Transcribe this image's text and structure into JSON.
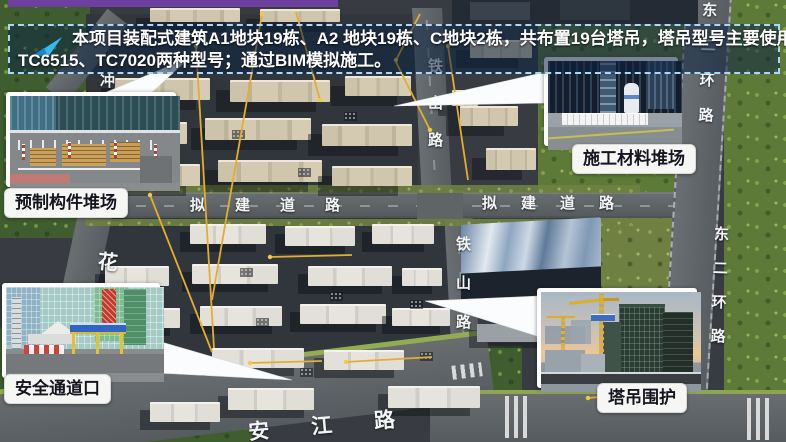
{
  "banner": {
    "icon": "paper-plane",
    "line1": "本项目装配式建筑A1地块19栋、A2 地块19栋、C地块2栋，共布置19台塔吊，塔吊型号主要使用",
    "line2": "TC6515、TC7020两种型号；通过BIM模拟施工。"
  },
  "callouts": {
    "prefab": {
      "label": "预制构件堆场"
    },
    "material": {
      "label": "施工材料堆场"
    },
    "safety": {
      "label": "安全通道口"
    },
    "crane": {
      "label": "塔吊围护"
    }
  },
  "roads": {
    "tieshan_north": "铁山路",
    "tieshan_south": "铁山路",
    "nijian_west": "拟建道路",
    "nijian_east": "拟建道路",
    "donger_top": "东二环路",
    "donger_mid": "东二环路",
    "hua": "花",
    "chong": "冲",
    "anjiang": "安江路"
  },
  "colors": {
    "banner_border": "#a9d9f7",
    "banner_bg": "rgba(13,34,66,0.55)",
    "accent_purple": "#6d3f9e",
    "crane_line": "#e3ae2f",
    "callout_bubble": "#f6f6f4"
  }
}
